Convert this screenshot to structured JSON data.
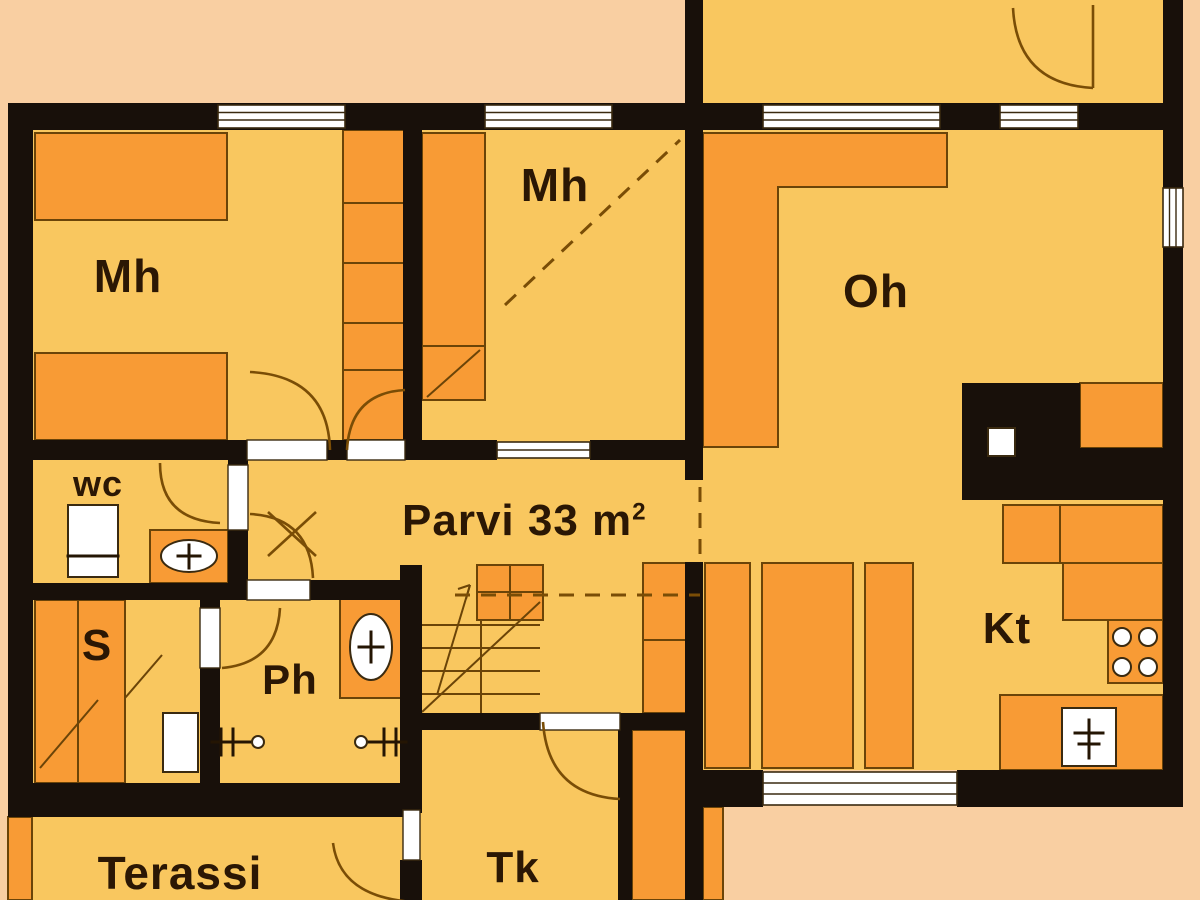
{
  "rooms": {
    "bedroom_left": {
      "label": "Mh"
    },
    "bedroom_mid": {
      "label": "Mh"
    },
    "living": {
      "label": "Oh"
    },
    "loft": {
      "label": "Parvi 33 m",
      "sup": "2"
    },
    "wc": {
      "label": "wc"
    },
    "sauna": {
      "label": "S"
    },
    "washroom": {
      "label": "Ph"
    },
    "kitchen": {
      "label": "Kt"
    },
    "vestibule": {
      "label": "Tk"
    },
    "terrace": {
      "label": "Terassi"
    }
  },
  "fixtures": {
    "stove": "stove-burners-icon",
    "sink": "kitchen-sink-icon",
    "toilet": "toilet-icon",
    "wc_basin": "washbasin-icon",
    "ph_basin": "washbasin-icon",
    "showers": "shower-head-icon",
    "sauna_stove": "sauna-stove-icon",
    "stairs": "staircase-icon",
    "chimney": "fireplace-chimney"
  },
  "colors": {
    "background": "#f9cfa2",
    "floor": "#f9c75f",
    "furniture": "#f89b35",
    "wall": "#18100a",
    "outline": "#6b4408",
    "window": "#ffffff",
    "window_frame": "#3a2a10",
    "door": "#7a4d06",
    "text": "#2b1704"
  }
}
